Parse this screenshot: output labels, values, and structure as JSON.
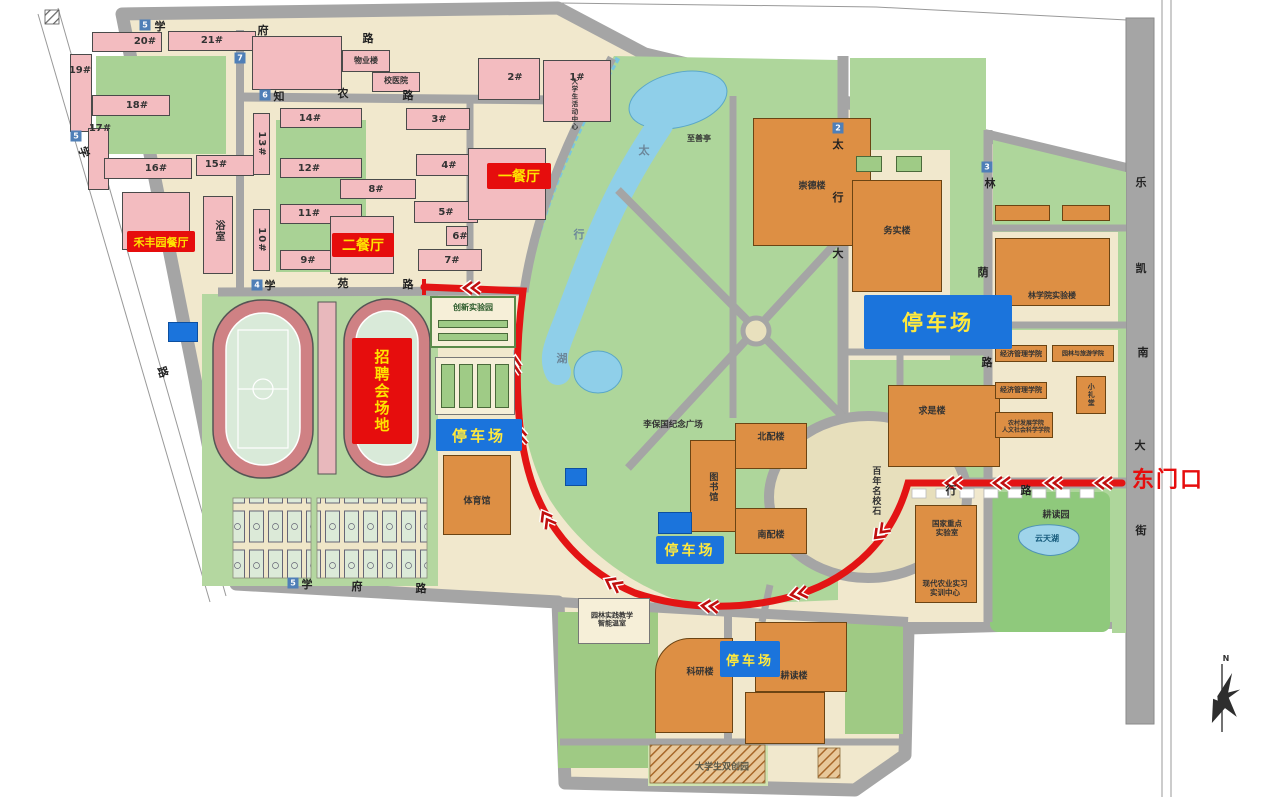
{
  "labels": {
    "wuye_lou": "物业楼",
    "xiao_yi_yuan": "校医院",
    "dorm_20": "20#",
    "dorm_21": "21#",
    "dorm_19": "19#",
    "dorm_18": "18#",
    "dorm_17": "17#",
    "dorm_16": "16#",
    "dorm_15": "15#",
    "dorm_14": "14#",
    "dorm_13": "13#",
    "dorm_12": "12#",
    "dorm_11": "11#",
    "dorm_10": "10#",
    "dorm_9": "9#",
    "dorm_8": "8#",
    "dorm_7": "7#",
    "dorm_6": "6#",
    "dorm_5": "5#",
    "dorm_4": "4#",
    "dorm_3": "3#",
    "dorm_2": "2#",
    "dorm_1": "1#",
    "yushi": "浴室",
    "hefengyuan_canting": "禾丰园餐厅",
    "er_canting": "二餐厅",
    "yi_canting": "一餐厅",
    "daxuesheng_huodong_zhongxin": "大学生活动中心",
    "zhishan_ting": "至善亭",
    "chongde_lou": "崇德楼",
    "wushi_lou": "务实楼",
    "linxueyuan_shiyanlou": "林学院实验楼",
    "jingji_guanli_1": "经济管理学院",
    "yuanlin_lvyou": "园林与旅游学院",
    "jingji_guanli_2": "经济管理学院",
    "xiao_litang": "小礼堂",
    "nongcun_renwen": "农村发展学院\n人文社会科学学院",
    "qiushi_lou": "求是楼",
    "libaoguo_guangchang": "李保国纪念广场",
    "bei_pei_lou": "北配楼",
    "tushuguan": "图书馆",
    "nan_pei_lou": "南配楼",
    "bainian_mingxiao_shi": "百年名校石",
    "guojia_zhongdian": "国家重点\n实验室",
    "xiandai_nongye": "现代农业实习\n实训中心",
    "gengdu_yuan": "耕读园",
    "yuntian_hu": "云天湖",
    "yuanlin_shijian": "园林实践教学\n智能温室",
    "tiyuguan": "体育馆",
    "keyan_lou": "科研楼",
    "gengdu_lou": "耕读楼",
    "shuangchuang_yuan": "大学生双创园",
    "chuangxin_shiyanyuan": "创新实验园",
    "zhaopin_changdi": "招聘会场地",
    "parking": "停车场",
    "dongmenkou": "东门口",
    "compass_n": "N"
  },
  "streets": {
    "xuefu_top": {
      "marker": "5",
      "chars": [
        "学",
        "府",
        "路"
      ]
    },
    "zhinong": {
      "marker": "6",
      "chars": [
        "知",
        "农",
        "路"
      ]
    },
    "xueyuan": {
      "marker": "4",
      "chars": [
        "学",
        "苑",
        "路"
      ]
    },
    "xuefu_bottom": {
      "marker": "5",
      "chars": [
        "学",
        "府",
        "路"
      ]
    },
    "xuefu_west": {
      "marker": "5",
      "chars": [
        "学",
        "路"
      ]
    },
    "road7": {
      "marker": "7"
    },
    "taihang_avenue": {
      "marker": "2",
      "chars": [
        "太",
        "行",
        "大"
      ]
    },
    "linyin": {
      "marker": "3",
      "chars": [
        "林",
        "荫",
        "路"
      ]
    },
    "lekai": {
      "chars": [
        "乐",
        "凯",
        "南",
        "大",
        "街"
      ]
    },
    "east_gate_road": {
      "chars": [
        "行",
        "路"
      ]
    }
  },
  "lake": {
    "chars": [
      "太",
      "行",
      "湖"
    ]
  },
  "colors": {
    "route_red": "#e31414",
    "sign_red": "#e60d0d",
    "sign_yellow": "#ffe300",
    "parking_blue": "#1b74dc",
    "road_gray": "#a5a5a5",
    "park_green": "#aed69b",
    "building_pink": "#f3bcc0",
    "building_orange": "#dd8f44",
    "water_blue": "#8fcfe9"
  }
}
